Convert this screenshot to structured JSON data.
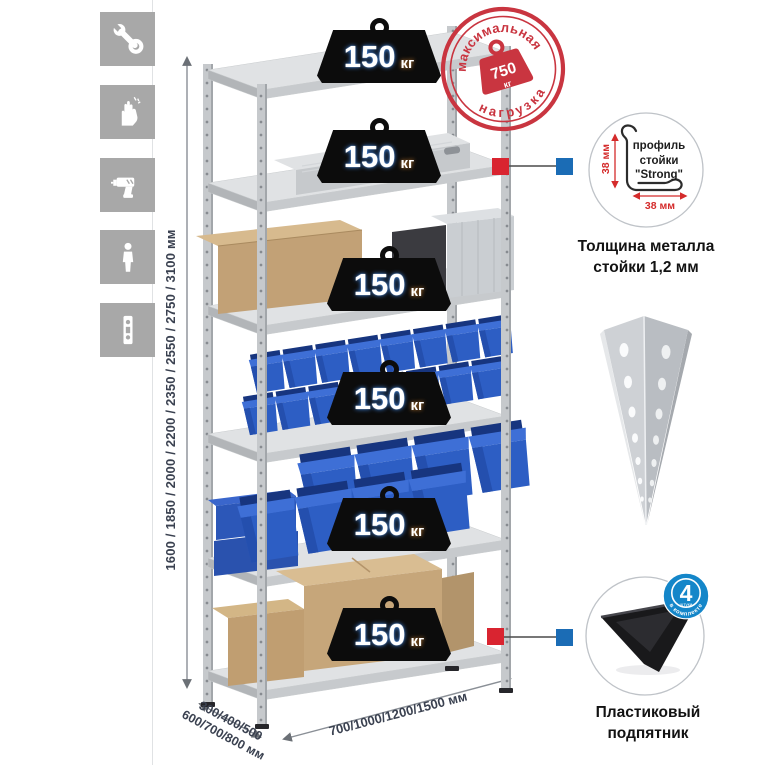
{
  "legend_icons": [
    {
      "icon": "wrench-icon"
    },
    {
      "icon": "gloves-icon"
    },
    {
      "icon": "drill-icon"
    },
    {
      "icon": "person-icon"
    },
    {
      "icon": "perforated-profile-icon"
    }
  ],
  "dimensions": {
    "height_label": "1600 / 1850 / 2000 / 2200 / 2350 / 2550 / 2750 / 3100 мм",
    "depth_label_line1": "300/400/500",
    "depth_label_line2": "600/700/800 мм",
    "width_label": "700/1000/1200/1500 мм"
  },
  "max_load_stamp": {
    "arc_top": "максимальная",
    "arc_bottom": "нагрузка",
    "value": "750",
    "unit": "кг"
  },
  "weights": [
    {
      "value": "150",
      "unit": "кг"
    },
    {
      "value": "150",
      "unit": "кг"
    },
    {
      "value": "150",
      "unit": "кг"
    },
    {
      "value": "150",
      "unit": "кг"
    },
    {
      "value": "150",
      "unit": "кг"
    },
    {
      "value": "150",
      "unit": "кг"
    }
  ],
  "profile_callout": {
    "line1": "профиль",
    "line2": "стойки",
    "line3": "\"Strong\"",
    "vertical_dim": "38 мм",
    "horizontal_dim": "38 мм",
    "caption_line1": "Толщина металла",
    "caption_line2": "стойки 1,2 мм"
  },
  "foot_callout": {
    "badge_number": "4",
    "badge_sub": "штуки",
    "badge_arc": "в комплекте",
    "caption_line1": "Пластиковый",
    "caption_line2": "подпятник"
  },
  "colors": {
    "stamp_red": "#c93540",
    "marker_red": "#d92430",
    "marker_blue": "#1b6cb5",
    "badge_blue": "#1486c9",
    "bin_blue": "#2d5ec4",
    "metal_gray": "#c6c9cc",
    "tile_gray": "#a8a8a8",
    "dimension_text": "#3a4150",
    "dim_red": "#d42b2b"
  }
}
